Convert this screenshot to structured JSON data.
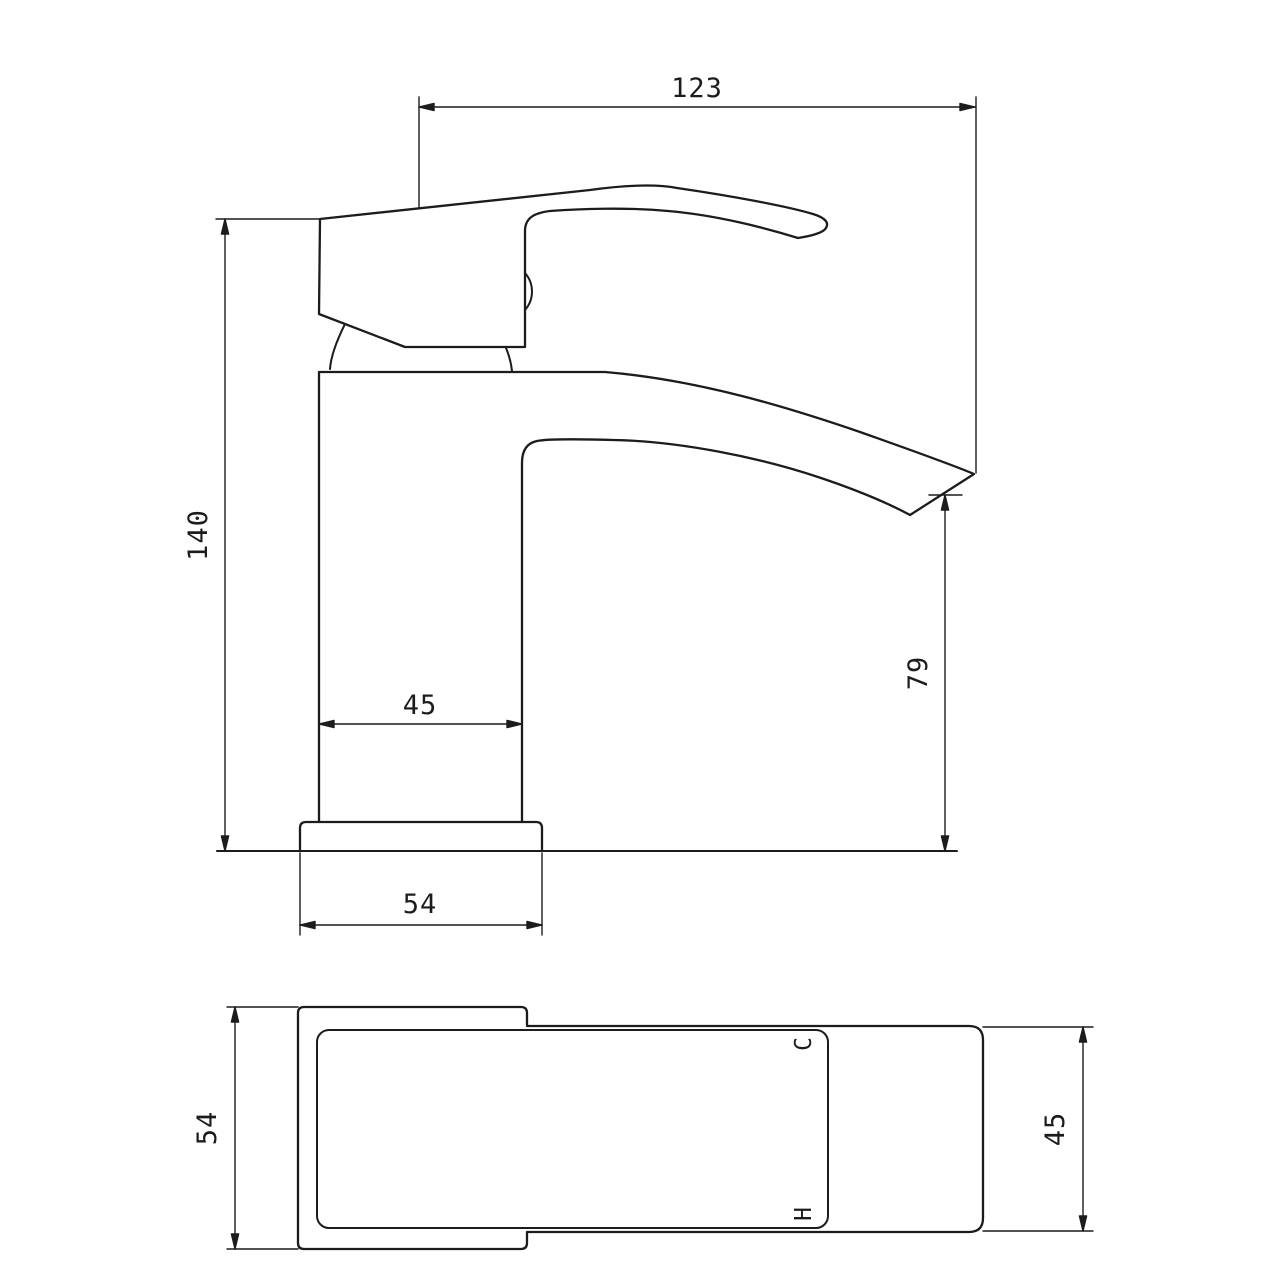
{
  "drawing": {
    "type": "technical-dimension-drawing",
    "subject": "basin mixer tap",
    "background_color": "#ffffff",
    "line_color": "#1c1c1c",
    "front_view": {
      "dims": {
        "overall_spout_reach": "123",
        "overall_height": "140",
        "body_width": "45",
        "spout_outlet_height": "79",
        "base_width": "54"
      }
    },
    "plan_view": {
      "dims": {
        "base_depth": "54",
        "spout_depth": "45"
      },
      "labels": {
        "cold": "C",
        "hot": "H"
      }
    }
  }
}
